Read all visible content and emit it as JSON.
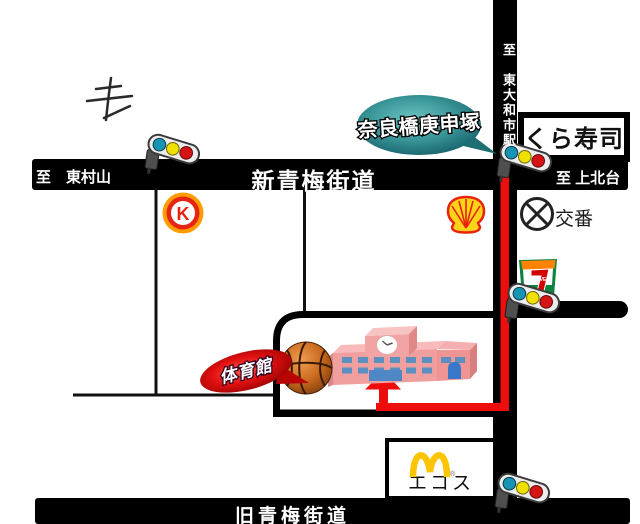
{
  "roads": {
    "shin_ome_label": "新青梅街道",
    "to_higashimurayama": "至　東村山",
    "to_kamikitadai": "至 上北台",
    "to_higashiyamato_station": "至　東大和市駅",
    "kyu_ome_label": "旧青梅街道"
  },
  "landmarks": {
    "intersection_bubble": "奈良橋庚申塚",
    "kura_sushi": "くら寿司",
    "koban": "交番",
    "gym_badge": "体育館",
    "ecos": "エコス",
    "circle_k_letter": "K",
    "seven_eleven_seven": "7",
    "seven_eleven_eleven": "ELEVEn",
    "mcdonalds_reg": "®"
  },
  "colors": {
    "road_black": "#000000",
    "route_red": "#ee0d0d",
    "bubble_teal": "#2e8f91",
    "badge_red": "#cc0505",
    "school_pink": "#f19e9e",
    "window_blue": "#5b8fc0",
    "circle_k_red": "#e62414",
    "shell_yellow": "#ffd31a",
    "shell_red": "#e8230b",
    "seven_eleven_green": "#0c8340",
    "mcdonalds_yellow": "#ffc400",
    "traffic_light_teal": "#1694b4",
    "traffic_light_yellow": "#efe000",
    "traffic_light_red": "#d61414"
  }
}
